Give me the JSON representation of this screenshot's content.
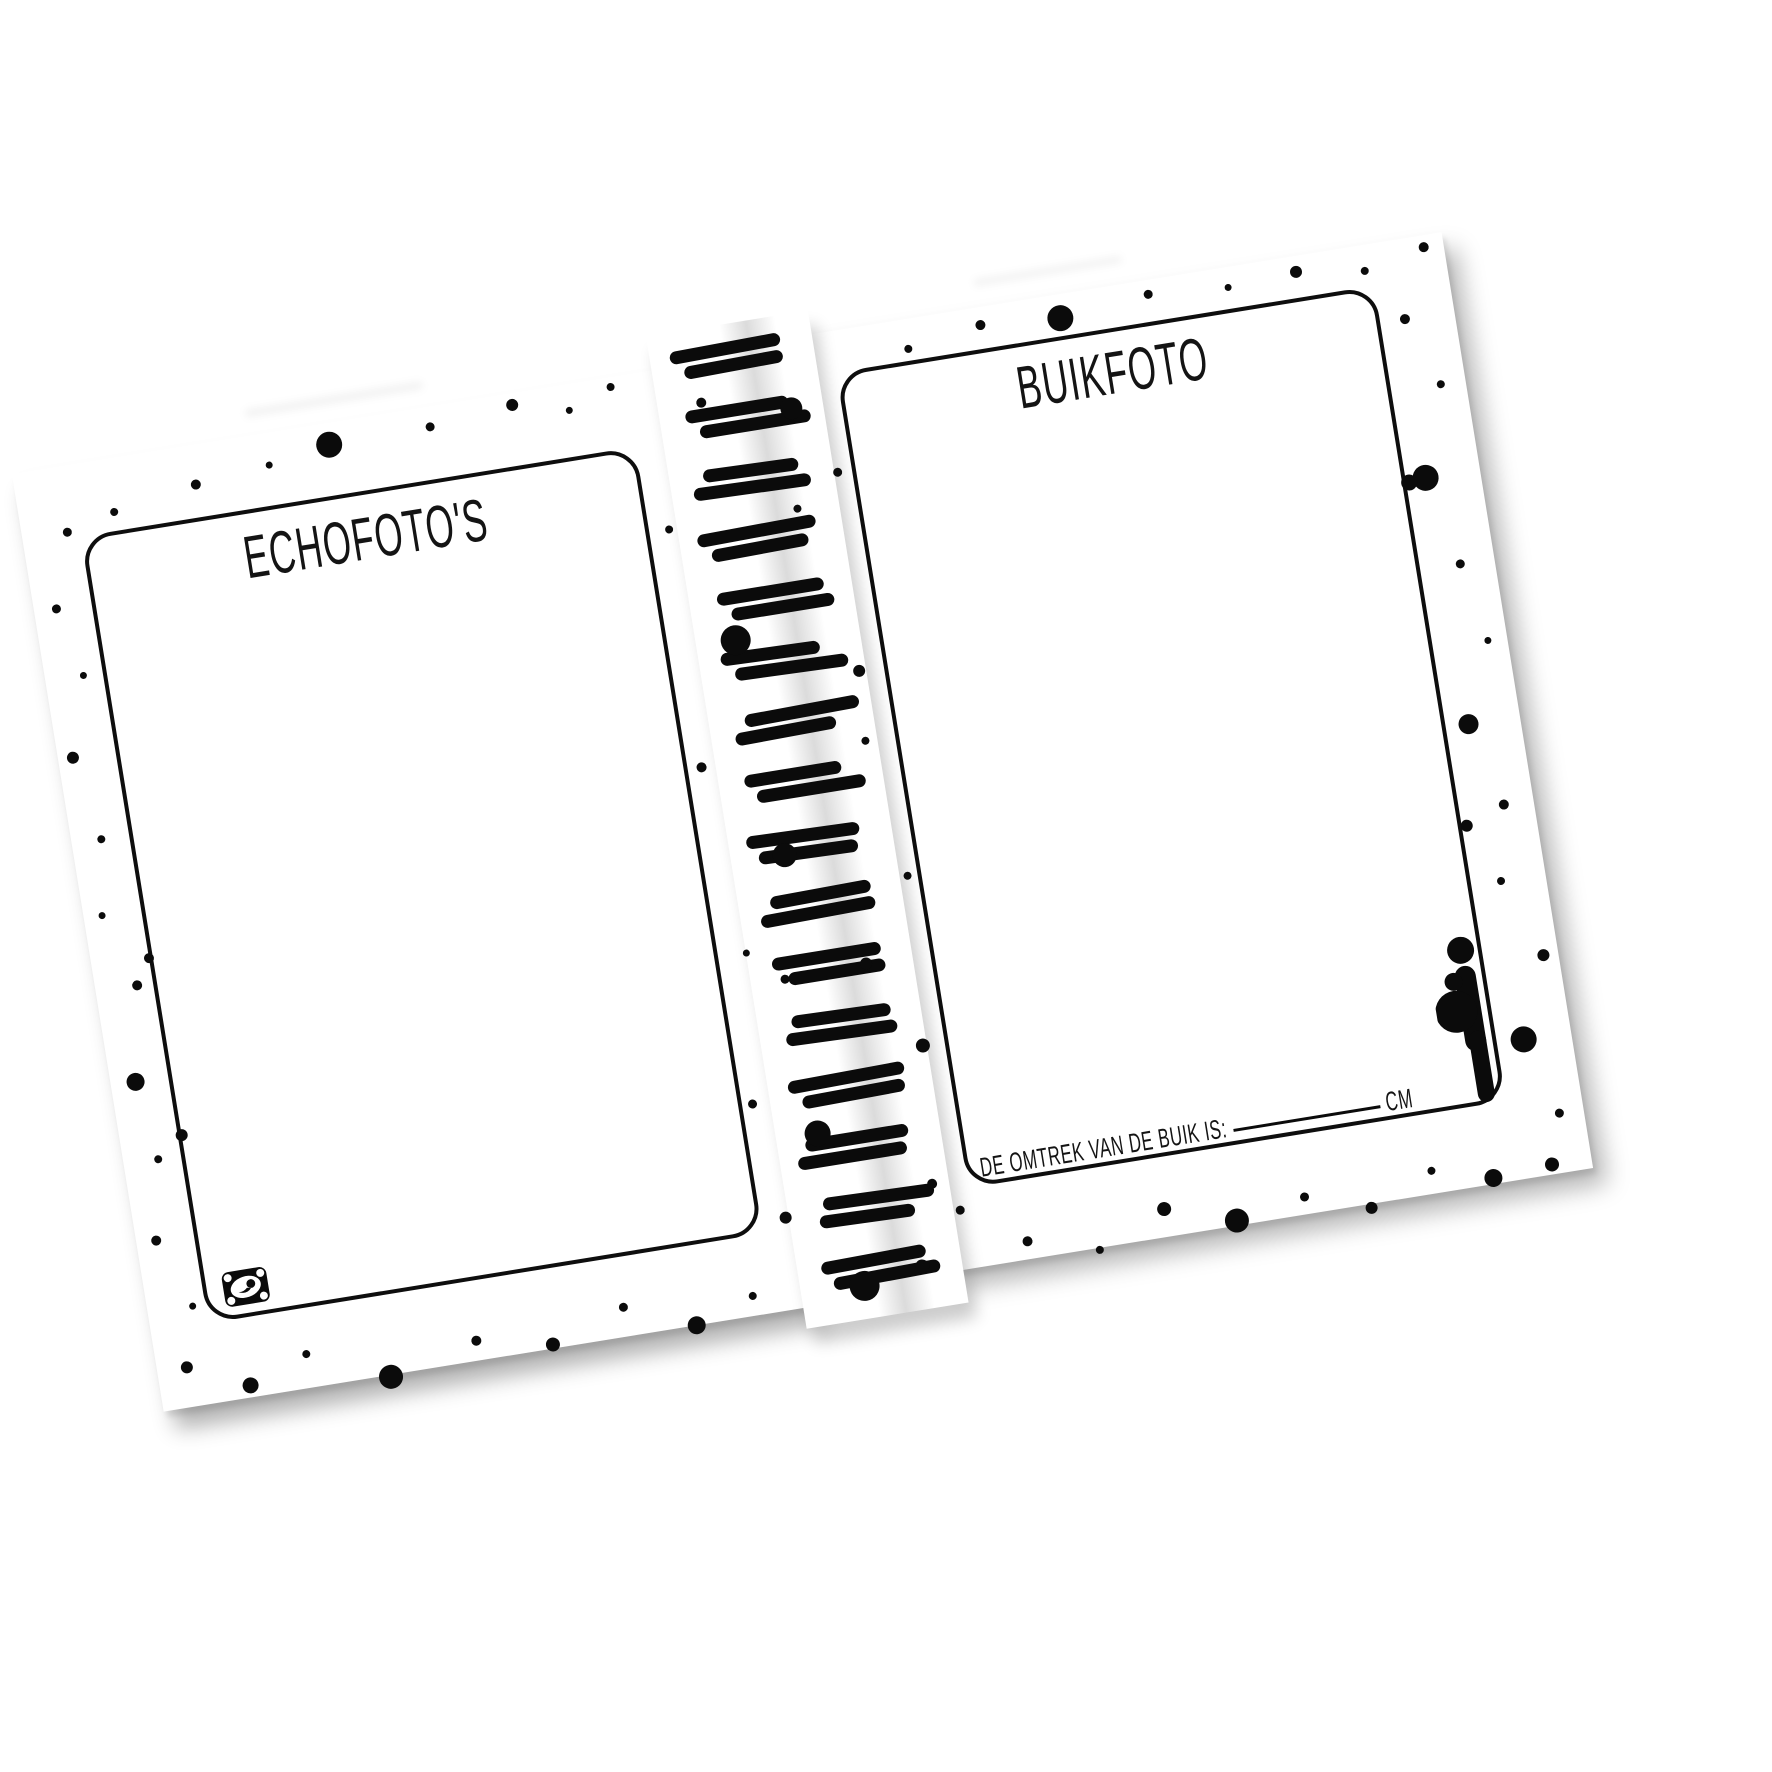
{
  "palette": {
    "paper": "#ffffff",
    "ink": "#0b0b0b",
    "gutter_shadow": "rgba(0,0,0,0.14)"
  },
  "left_page": {
    "heading": "ECHOFOTO'S",
    "stamp_icon": "ultrasound-stamp-icon"
  },
  "right_page": {
    "heading": "BUIKFOTO",
    "belly_label": "DE OMTREK VAN DE BUIK IS:",
    "belly_unit": "CM",
    "figure_icon": "pregnant-woman-icon"
  },
  "spine": {
    "coils": [
      {
        "y": 18,
        "a": [
          -8,
          112
        ],
        "b": [
          4,
          100
        ]
      },
      {
        "y": 80,
        "a": [
          -2,
          104
        ],
        "b": [
          10,
          112
        ]
      },
      {
        "y": 142,
        "a": [
          6,
          96
        ],
        "b": [
          -6,
          118
        ]
      },
      {
        "y": 203,
        "a": [
          -10,
          120
        ],
        "b": [
          2,
          98
        ]
      },
      {
        "y": 265,
        "a": [
          0,
          108
        ],
        "b": [
          12,
          104
        ]
      },
      {
        "y": 326,
        "a": [
          -6,
          100
        ],
        "b": [
          6,
          114
        ]
      },
      {
        "y": 388,
        "a": [
          8,
          116
        ],
        "b": [
          -4,
          102
        ]
      },
      {
        "y": 449,
        "a": [
          -2,
          98
        ],
        "b": [
          8,
          110
        ]
      },
      {
        "y": 511,
        "a": [
          -10,
          114
        ],
        "b": [
          0,
          100
        ]
      },
      {
        "y": 572,
        "a": [
          4,
          102
        ],
        "b": [
          -8,
          116
        ]
      },
      {
        "y": 634,
        "a": [
          -4,
          110
        ],
        "b": [
          10,
          98
        ]
      },
      {
        "y": 695,
        "a": [
          6,
          100
        ],
        "b": [
          -2,
          112
        ]
      },
      {
        "y": 757,
        "a": [
          -8,
          118
        ],
        "b": [
          4,
          104
        ]
      },
      {
        "y": 818,
        "a": [
          0,
          104
        ],
        "b": [
          -10,
          110
        ]
      },
      {
        "y": 880,
        "a": [
          8,
          112
        ],
        "b": [
          2,
          96
        ]
      },
      {
        "y": 941,
        "a": [
          -4,
          106
        ],
        "b": [
          6,
          108
        ]
      }
    ]
  },
  "decor": {
    "dots": [
      [
        318,
        42,
        26
      ],
      [
        180,
        60,
        10
      ],
      [
        95,
        74,
        8
      ],
      [
        255,
        52,
        7
      ],
      [
        420,
        40,
        9
      ],
      [
        505,
        32,
        12
      ],
      [
        560,
        46,
        7
      ],
      [
        45,
        86,
        9
      ],
      [
        605,
        30,
        8
      ],
      [
        22,
        160,
        9
      ],
      [
        38,
        230,
        7
      ],
      [
        15,
        310,
        12
      ],
      [
        30,
        395,
        8
      ],
      [
        18,
        470,
        7
      ],
      [
        42,
        545,
        10
      ],
      [
        25,
        640,
        18
      ],
      [
        35,
        720,
        8
      ],
      [
        20,
        800,
        10
      ],
      [
        45,
        870,
        7
      ],
      [
        30,
        930,
        12
      ],
      [
        58,
        520,
        10
      ],
      [
        62,
        700,
        12
      ],
      [
        90,
        958,
        16
      ],
      [
        150,
        936,
        8
      ],
      [
        230,
        972,
        24
      ],
      [
        320,
        950,
        10
      ],
      [
        395,
        966,
        14
      ],
      [
        470,
        940,
        9
      ],
      [
        540,
        970,
        18
      ],
      [
        600,
        950,
        8
      ],
      [
        640,
        180,
        8
      ],
      [
        634,
        420,
        10
      ],
      [
        648,
        610,
        7
      ],
      [
        630,
        760,
        9
      ],
      [
        645,
        878,
        12
      ],
      [
        688,
        300,
        30
      ],
      [
        702,
        520,
        24
      ],
      [
        780,
        80,
        22
      ],
      [
        765,
        640,
        12
      ],
      [
        690,
        800,
        26
      ],
      [
        795,
        868,
        10
      ],
      [
        772,
        948,
        14
      ],
      [
        712,
        958,
        30
      ],
      [
        770,
        180,
        8
      ],
      [
        682,
        642,
        9
      ],
      [
        800,
        420,
        8
      ],
      [
        692,
        60,
        10
      ],
      [
        815,
        150,
        9
      ],
      [
        805,
        350,
        12
      ],
      [
        820,
        560,
        8
      ],
      [
        808,
        730,
        14
      ],
      [
        818,
        898,
        9
      ],
      [
        905,
        40,
        8
      ],
      [
        980,
        28,
        10
      ],
      [
        1060,
        34,
        26
      ],
      [
        1150,
        24,
        9
      ],
      [
        1230,
        30,
        7
      ],
      [
        1300,
        26,
        12
      ],
      [
        1368,
        36,
        8
      ],
      [
        1430,
        22,
        10
      ],
      [
        1400,
        90,
        10
      ],
      [
        1425,
        160,
        8
      ],
      [
        1395,
        250,
        26
      ],
      [
        1415,
        340,
        9
      ],
      [
        1430,
        420,
        7
      ],
      [
        1398,
        500,
        20
      ],
      [
        1420,
        585,
        10
      ],
      [
        1405,
        660,
        8
      ],
      [
        1435,
        740,
        12
      ],
      [
        1402,
        820,
        26
      ],
      [
        1425,
        898,
        9
      ],
      [
        1410,
        948,
        14
      ],
      [
        1378,
        252,
        16
      ],
      [
        1380,
        600,
        12
      ],
      [
        880,
        940,
        10
      ],
      [
        950,
        960,
        8
      ],
      [
        1020,
        930,
        14
      ],
      [
        1090,
        953,
        24
      ],
      [
        1160,
        940,
        9
      ],
      [
        1225,
        962,
        12
      ],
      [
        1290,
        935,
        8
      ],
      [
        1350,
        952,
        18
      ]
    ]
  }
}
